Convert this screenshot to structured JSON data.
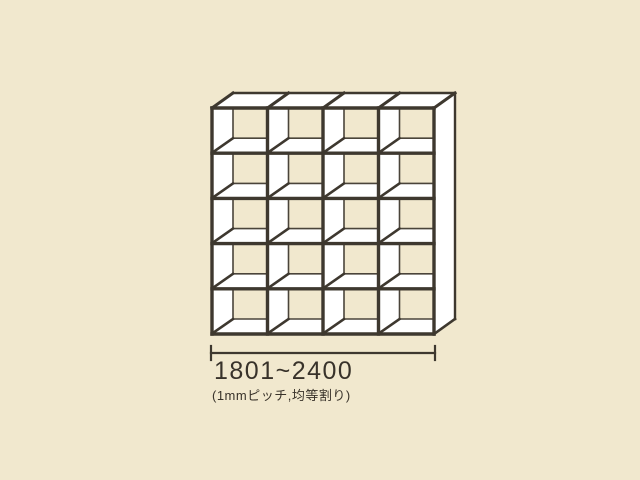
{
  "page": {
    "background": "#f1e8ce"
  },
  "diagram": {
    "description": "open cubby shelf unit, oblique projection",
    "columns": 4,
    "rows": 5,
    "front": {
      "x": 212,
      "y": 108,
      "width": 222,
      "height": 226
    },
    "depth_offset": {
      "dx": 21,
      "dy": 15
    },
    "colors": {
      "outline": "#3e382f",
      "inner_line": "#4a443a",
      "surface": "#ffffff",
      "opening": "#f1e8ce"
    },
    "stroke": {
      "thick": 3.4,
      "medium": 2.6,
      "thin": 1.6
    }
  },
  "dimension": {
    "line": {
      "x1": 211,
      "x2": 435,
      "y": 353,
      "tick_top": 346,
      "tick_bottom": 360
    },
    "label": "1801~2400",
    "note": "(1mmピッチ,均等割り)",
    "text_color": "#38322a"
  }
}
